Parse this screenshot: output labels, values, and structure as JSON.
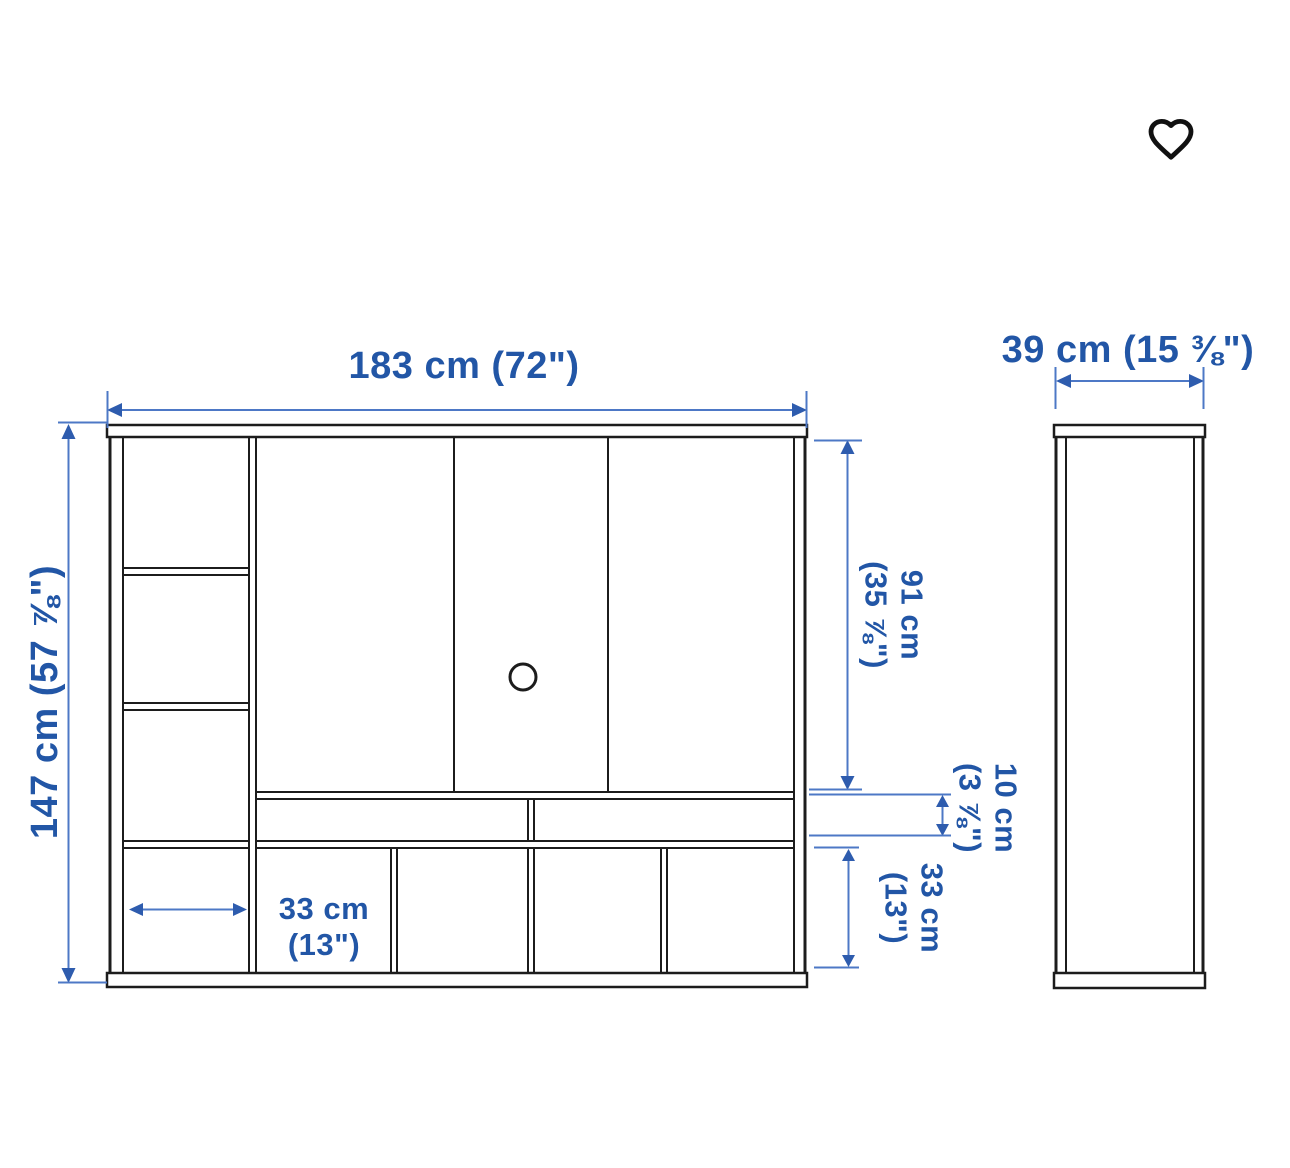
{
  "favorite": {
    "label": "save to favorites",
    "icon": "heart-outline"
  },
  "diagram": {
    "description": "furniture dimension drawing, front view and side view",
    "views": {
      "front": "front view",
      "side": "side view"
    },
    "dimensions": {
      "overall_width": {
        "label": "183 cm (72\")"
      },
      "depth": {
        "label": "39 cm (15 ⅜\")"
      },
      "overall_height": {
        "label": "147 cm (57 ⅞\")"
      },
      "upper_section_height": {
        "line1": "91 cm",
        "line2": "(35 ⅞\")"
      },
      "drawer_section_height": {
        "line1": "10 cm",
        "line2": "(3 ⅞\")"
      },
      "lower_section_height": {
        "line1": "33 cm",
        "line2": "(13\")"
      },
      "compartment_width": {
        "line1": "33 cm",
        "line2": "(13\")"
      }
    },
    "colors": {
      "background": "#ffffff",
      "drawing_line": "#1c1c1c",
      "dimension_text": "#2256a6",
      "dimension_line": "#4d78c6",
      "arrowhead": "#2e5cae",
      "heart_icon": "#111111"
    }
  }
}
